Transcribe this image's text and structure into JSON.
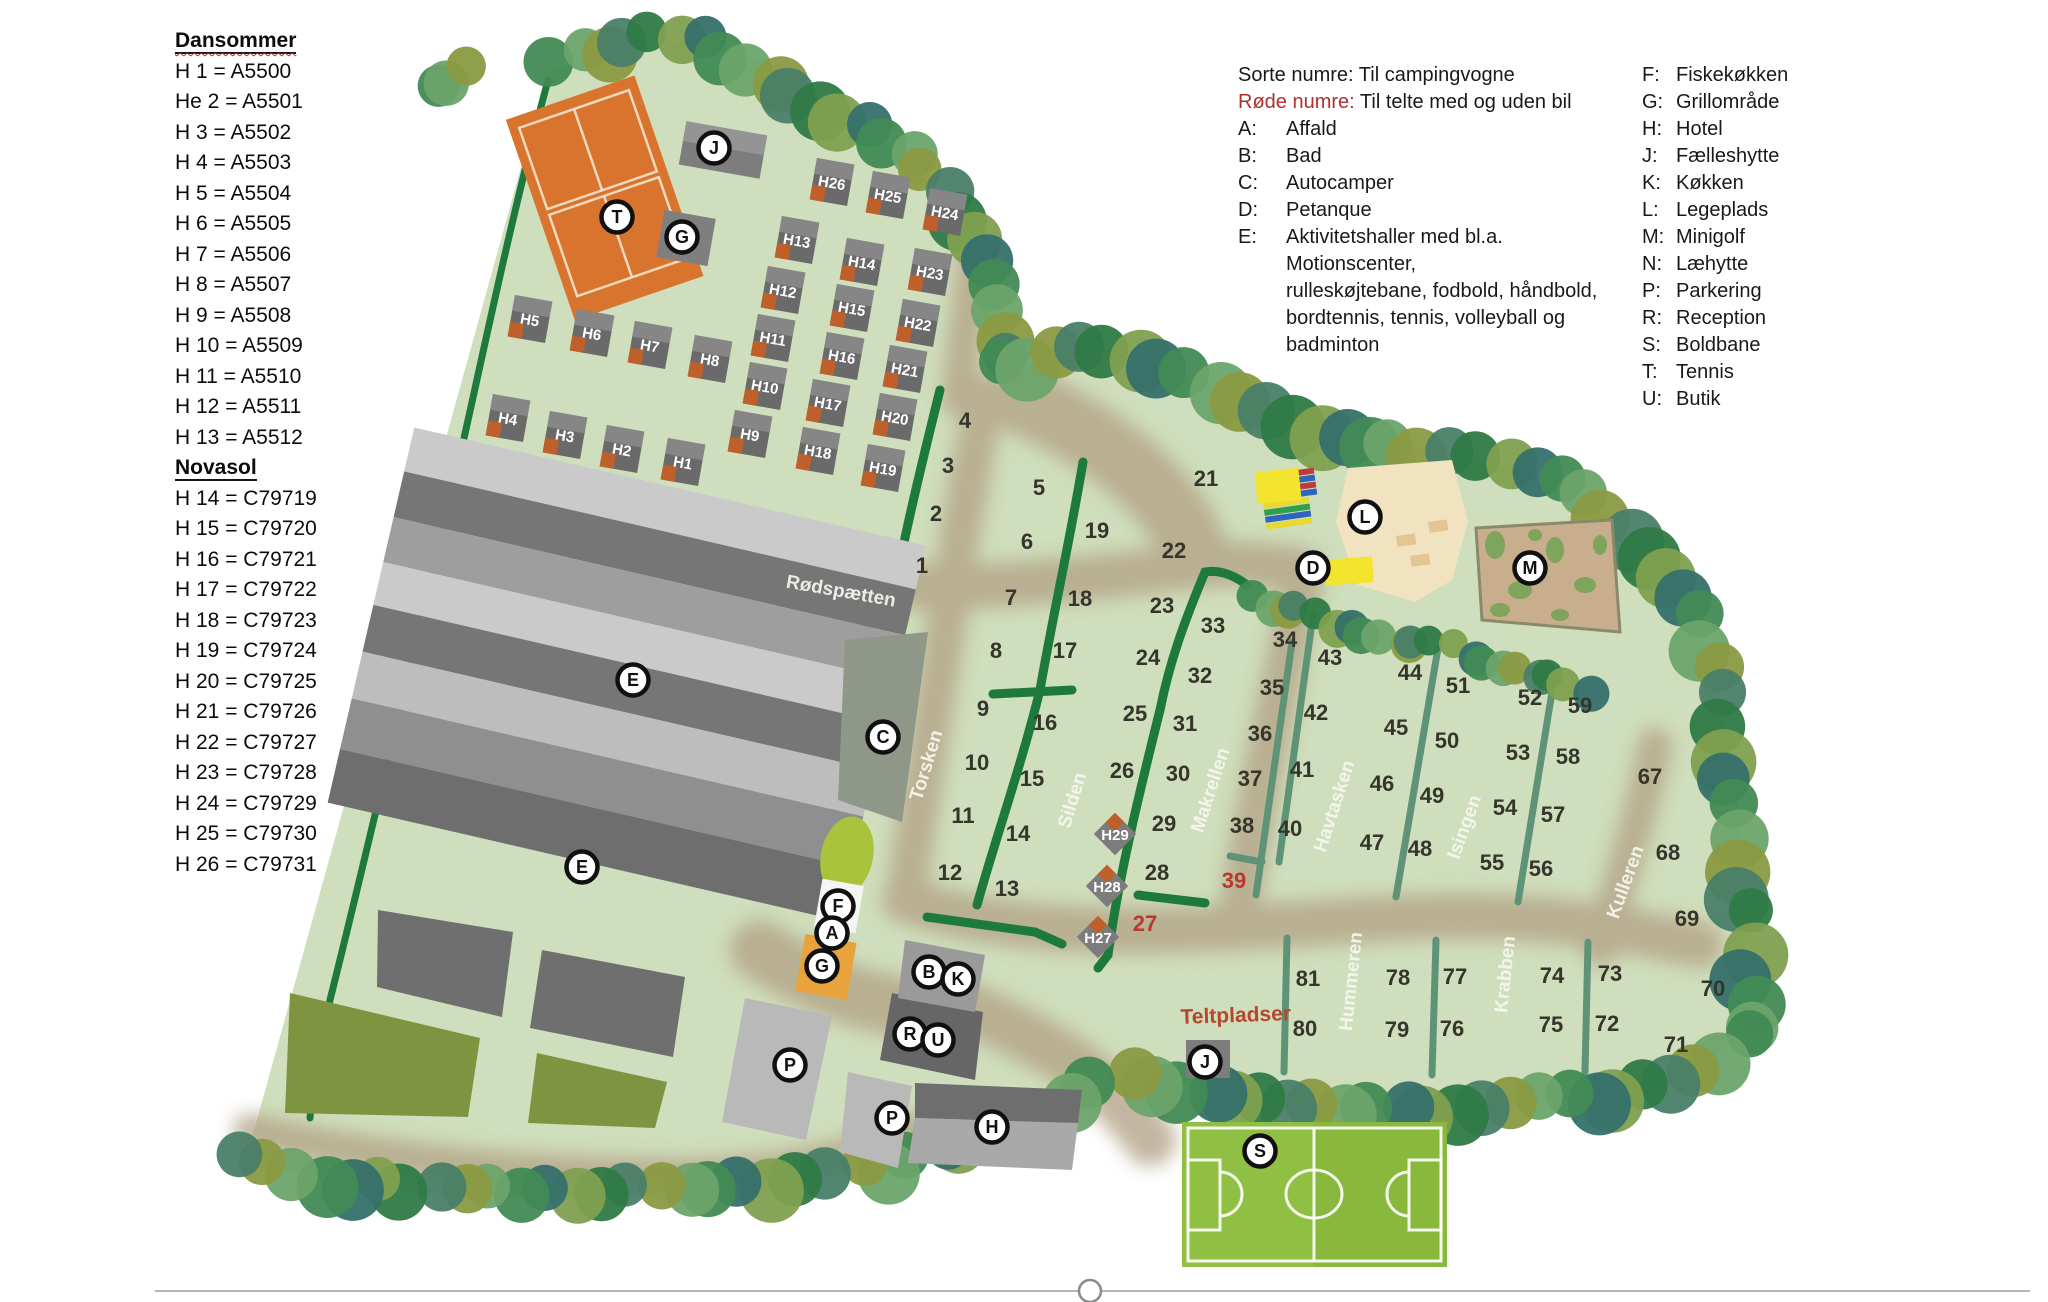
{
  "sidebar": {
    "sections": [
      {
        "title": "Dansommer",
        "items": [
          "H 1 = A5500",
          "He 2 = A5501",
          "H 3 = A5502",
          "H 4 = A5503",
          "H 5 = A5504",
          "H 6 = A5505",
          "H 7 = A5506",
          "H 8 = A5507",
          "H 9 = A5508",
          "H 10 = A5509",
          "H 11 = A5510",
          "H 12 = A5511",
          "H 13 = A5512"
        ]
      },
      {
        "title": "Novasol",
        "items": [
          "H 14 = C79719",
          "H 15 = C79720",
          "H 16 = C79721",
          "H 17 = C79722",
          "H 18 = C79723",
          "H 19 = C79724",
          "H 20 = C79725",
          "H 21 = C79726",
          "H 22 = C79727",
          "H 23 = C79728",
          "H 24 = C79729",
          "H 25 = C79730",
          "H 26  = C79731"
        ]
      }
    ]
  },
  "legend": {
    "line1_label": "Sorte numre:",
    "line1_text": "Til campingvogne",
    "line2_label": "Røde numre:",
    "line2_text": "Til telte med og uden bil",
    "col1": [
      {
        "key": "A:",
        "lines": [
          "Affald"
        ]
      },
      {
        "key": "B:",
        "lines": [
          "Bad"
        ]
      },
      {
        "key": "C:",
        "lines": [
          "Autocamper"
        ]
      },
      {
        "key": "D:",
        "lines": [
          "Petanque"
        ]
      },
      {
        "key": "E:",
        "lines": [
          "Aktivitetshaller med bl.a. Motionscenter,",
          "rulleskøjtebane, fodbold, håndbold,",
          "bordtennis, tennis, volleyball og",
          "badminton"
        ]
      }
    ],
    "col2": [
      {
        "key": "F:",
        "lines": [
          "Fiskekøkken"
        ]
      },
      {
        "key": "G:",
        "lines": [
          "Grillområde"
        ]
      },
      {
        "key": "H:",
        "lines": [
          "Hotel"
        ]
      },
      {
        "key": "J:",
        "lines": [
          "Fælleshytte"
        ]
      },
      {
        "key": "K:",
        "lines": [
          "Køkken"
        ]
      },
      {
        "key": "L:",
        "lines": [
          "Legeplads"
        ]
      },
      {
        "key": "M:",
        "lines": [
          "Minigolf"
        ]
      },
      {
        "key": "N:",
        "lines": [
          "Læhytte"
        ]
      },
      {
        "key": "P:",
        "lines": [
          "Parkering"
        ]
      },
      {
        "key": "R:",
        "lines": [
          "Reception"
        ]
      },
      {
        "key": "S:",
        "lines": [
          "Boldbane"
        ]
      },
      {
        "key": "T:",
        "lines": [
          "Tennis"
        ]
      },
      {
        "key": "U:",
        "lines": [
          "Butik"
        ]
      }
    ]
  },
  "map": {
    "plots": [
      {
        "n": "1",
        "x": 922,
        "y": 565
      },
      {
        "n": "2",
        "x": 936,
        "y": 513
      },
      {
        "n": "3",
        "x": 948,
        "y": 465
      },
      {
        "n": "4",
        "x": 965,
        "y": 420
      },
      {
        "n": "5",
        "x": 1039,
        "y": 487
      },
      {
        "n": "6",
        "x": 1027,
        "y": 541
      },
      {
        "n": "7",
        "x": 1011,
        "y": 597
      },
      {
        "n": "8",
        "x": 996,
        "y": 650
      },
      {
        "n": "9",
        "x": 983,
        "y": 708
      },
      {
        "n": "10",
        "x": 977,
        "y": 762
      },
      {
        "n": "11",
        "x": 963,
        "y": 815
      },
      {
        "n": "12",
        "x": 950,
        "y": 872
      },
      {
        "n": "13",
        "x": 1007,
        "y": 888
      },
      {
        "n": "14",
        "x": 1018,
        "y": 833
      },
      {
        "n": "15",
        "x": 1032,
        "y": 778
      },
      {
        "n": "16",
        "x": 1045,
        "y": 722
      },
      {
        "n": "17",
        "x": 1065,
        "y": 650
      },
      {
        "n": "18",
        "x": 1080,
        "y": 598
      },
      {
        "n": "19",
        "x": 1097,
        "y": 530
      },
      {
        "n": "21",
        "x": 1206,
        "y": 478
      },
      {
        "n": "22",
        "x": 1174,
        "y": 550
      },
      {
        "n": "23",
        "x": 1162,
        "y": 605
      },
      {
        "n": "24",
        "x": 1148,
        "y": 657
      },
      {
        "n": "25",
        "x": 1135,
        "y": 713
      },
      {
        "n": "26",
        "x": 1122,
        "y": 770
      },
      {
        "n": "27",
        "x": 1145,
        "y": 923,
        "red": true
      },
      {
        "n": "28",
        "x": 1157,
        "y": 872
      },
      {
        "n": "29",
        "x": 1164,
        "y": 823
      },
      {
        "n": "30",
        "x": 1178,
        "y": 773
      },
      {
        "n": "31",
        "x": 1185,
        "y": 723
      },
      {
        "n": "32",
        "x": 1200,
        "y": 675
      },
      {
        "n": "33",
        "x": 1213,
        "y": 625
      },
      {
        "n": "34",
        "x": 1285,
        "y": 639
      },
      {
        "n": "35",
        "x": 1272,
        "y": 687
      },
      {
        "n": "36",
        "x": 1260,
        "y": 733
      },
      {
        "n": "37",
        "x": 1250,
        "y": 778
      },
      {
        "n": "38",
        "x": 1242,
        "y": 825
      },
      {
        "n": "39",
        "x": 1234,
        "y": 880,
        "red": true
      },
      {
        "n": "40",
        "x": 1290,
        "y": 828
      },
      {
        "n": "41",
        "x": 1302,
        "y": 769
      },
      {
        "n": "42",
        "x": 1316,
        "y": 712
      },
      {
        "n": "43",
        "x": 1330,
        "y": 657
      },
      {
        "n": "44",
        "x": 1410,
        "y": 672
      },
      {
        "n": "45",
        "x": 1396,
        "y": 727
      },
      {
        "n": "46",
        "x": 1382,
        "y": 783
      },
      {
        "n": "47",
        "x": 1372,
        "y": 842
      },
      {
        "n": "48",
        "x": 1420,
        "y": 848
      },
      {
        "n": "49",
        "x": 1432,
        "y": 795
      },
      {
        "n": "50",
        "x": 1447,
        "y": 740
      },
      {
        "n": "51",
        "x": 1458,
        "y": 685
      },
      {
        "n": "52",
        "x": 1530,
        "y": 697
      },
      {
        "n": "53",
        "x": 1518,
        "y": 752
      },
      {
        "n": "54",
        "x": 1505,
        "y": 807
      },
      {
        "n": "55",
        "x": 1492,
        "y": 862
      },
      {
        "n": "56",
        "x": 1541,
        "y": 868
      },
      {
        "n": "57",
        "x": 1553,
        "y": 814
      },
      {
        "n": "58",
        "x": 1568,
        "y": 756
      },
      {
        "n": "59",
        "x": 1580,
        "y": 705
      },
      {
        "n": "67",
        "x": 1650,
        "y": 776
      },
      {
        "n": "68",
        "x": 1668,
        "y": 852
      },
      {
        "n": "69",
        "x": 1687,
        "y": 918
      },
      {
        "n": "70",
        "x": 1713,
        "y": 988
      },
      {
        "n": "71",
        "x": 1676,
        "y": 1044
      },
      {
        "n": "72",
        "x": 1607,
        "y": 1023
      },
      {
        "n": "73",
        "x": 1610,
        "y": 973
      },
      {
        "n": "74",
        "x": 1552,
        "y": 975
      },
      {
        "n": "75",
        "x": 1551,
        "y": 1024
      },
      {
        "n": "76",
        "x": 1452,
        "y": 1028
      },
      {
        "n": "77",
        "x": 1455,
        "y": 976
      },
      {
        "n": "78",
        "x": 1398,
        "y": 977
      },
      {
        "n": "79",
        "x": 1397,
        "y": 1029
      },
      {
        "n": "80",
        "x": 1305,
        "y": 1028
      },
      {
        "n": "81",
        "x": 1308,
        "y": 978
      }
    ],
    "cabins": [
      {
        "label": "H1",
        "x": 683,
        "y": 462
      },
      {
        "label": "H2",
        "x": 622,
        "y": 449
      },
      {
        "label": "H3",
        "x": 565,
        "y": 435
      },
      {
        "label": "H4",
        "x": 508,
        "y": 418
      },
      {
        "label": "H5",
        "x": 530,
        "y": 319
      },
      {
        "label": "H6",
        "x": 592,
        "y": 333
      },
      {
        "label": "H7",
        "x": 650,
        "y": 345
      },
      {
        "label": "H8",
        "x": 710,
        "y": 359
      },
      {
        "label": "H9",
        "x": 750,
        "y": 434
      },
      {
        "label": "H10",
        "x": 765,
        "y": 386
      },
      {
        "label": "H11",
        "x": 773,
        "y": 338
      },
      {
        "label": "H12",
        "x": 783,
        "y": 290
      },
      {
        "label": "H13",
        "x": 797,
        "y": 240
      },
      {
        "label": "H14",
        "x": 862,
        "y": 262
      },
      {
        "label": "H15",
        "x": 852,
        "y": 308
      },
      {
        "label": "H16",
        "x": 842,
        "y": 356
      },
      {
        "label": "H17",
        "x": 828,
        "y": 403
      },
      {
        "label": "H18",
        "x": 818,
        "y": 451
      },
      {
        "label": "H19",
        "x": 883,
        "y": 468
      },
      {
        "label": "H20",
        "x": 895,
        "y": 417
      },
      {
        "label": "H21",
        "x": 905,
        "y": 369
      },
      {
        "label": "H22",
        "x": 918,
        "y": 323
      },
      {
        "label": "H23",
        "x": 930,
        "y": 272
      },
      {
        "label": "H24",
        "x": 945,
        "y": 212
      },
      {
        "label": "H25",
        "x": 888,
        "y": 195
      },
      {
        "label": "H26",
        "x": 832,
        "y": 182
      }
    ],
    "diamond_cabins": [
      {
        "label": "H27",
        "x": 1098,
        "y": 937
      },
      {
        "label": "H28",
        "x": 1107,
        "y": 886
      },
      {
        "label": "H29",
        "x": 1115,
        "y": 834
      }
    ],
    "facilities": [
      {
        "letter": "T",
        "x": 617,
        "y": 217,
        "name": "tennis"
      },
      {
        "letter": "J",
        "x": 714,
        "y": 148,
        "name": "faelleshytte"
      },
      {
        "letter": "G",
        "x": 682,
        "y": 237,
        "name": "grill-nord"
      },
      {
        "letter": "E",
        "x": 633,
        "y": 680,
        "name": "aktivitetshal-1"
      },
      {
        "letter": "E",
        "x": 582,
        "y": 867,
        "name": "aktivitetshal-2"
      },
      {
        "letter": "C",
        "x": 883,
        "y": 737,
        "name": "autocamper"
      },
      {
        "letter": "F",
        "x": 838,
        "y": 906,
        "name": "fiskekokken"
      },
      {
        "letter": "A",
        "x": 832,
        "y": 933,
        "name": "affald"
      },
      {
        "letter": "G",
        "x": 822,
        "y": 966,
        "name": "grill-syd"
      },
      {
        "letter": "B",
        "x": 929,
        "y": 972,
        "name": "bad"
      },
      {
        "letter": "K",
        "x": 958,
        "y": 979,
        "name": "kokken"
      },
      {
        "letter": "R",
        "x": 910,
        "y": 1034,
        "name": "reception"
      },
      {
        "letter": "U",
        "x": 938,
        "y": 1040,
        "name": "butik"
      },
      {
        "letter": "P",
        "x": 790,
        "y": 1065,
        "name": "parkering-1"
      },
      {
        "letter": "P",
        "x": 892,
        "y": 1118,
        "name": "parkering-2"
      },
      {
        "letter": "H",
        "x": 992,
        "y": 1127,
        "name": "hotel"
      },
      {
        "letter": "D",
        "x": 1313,
        "y": 568,
        "name": "petanque"
      },
      {
        "letter": "L",
        "x": 1365,
        "y": 517,
        "name": "legeplads"
      },
      {
        "letter": "M",
        "x": 1530,
        "y": 568,
        "name": "minigolf"
      },
      {
        "letter": "J",
        "x": 1205,
        "y": 1062,
        "name": "faelleshytte-telt"
      },
      {
        "letter": "S",
        "x": 1260,
        "y": 1151,
        "name": "boldbane"
      }
    ],
    "roads": [
      {
        "name": "Rødspætten",
        "x": 840,
        "y": 597,
        "angle": 10
      },
      {
        "name": "Torsken",
        "x": 932,
        "y": 767,
        "angle": -73
      },
      {
        "name": "Silden",
        "x": 1078,
        "y": 802,
        "angle": -73
      },
      {
        "name": "Makrellen",
        "x": 1216,
        "y": 792,
        "angle": -72
      },
      {
        "name": "Havtasken",
        "x": 1340,
        "y": 808,
        "angle": -72
      },
      {
        "name": "Isingen",
        "x": 1470,
        "y": 829,
        "angle": -70
      },
      {
        "name": "Kulleren",
        "x": 1631,
        "y": 884,
        "angle": -70
      },
      {
        "name": "Hummeren",
        "x": 1357,
        "y": 982,
        "angle": -84
      },
      {
        "name": "Krabben",
        "x": 1511,
        "y": 975,
        "angle": -84
      }
    ],
    "teltpladser": {
      "text": "Teltpladser",
      "x": 1236,
      "y": 1022
    },
    "colors": {
      "ground": "#cfdebc",
      "path": "#b3a286",
      "tree": "#2e7a46",
      "hedge": "#1d7a3c",
      "teal_line": "#5f9377",
      "tennis": "#d9742f",
      "red_text": "#b8392e",
      "field": "#8ebe3e",
      "building": "#767676",
      "cabin": "#6a6a6a",
      "cabin_accent": "#bf5f2a",
      "minigolf": "#c9ae8e",
      "playground": "#f2e3c0",
      "yellow": "#f3e42f"
    }
  }
}
